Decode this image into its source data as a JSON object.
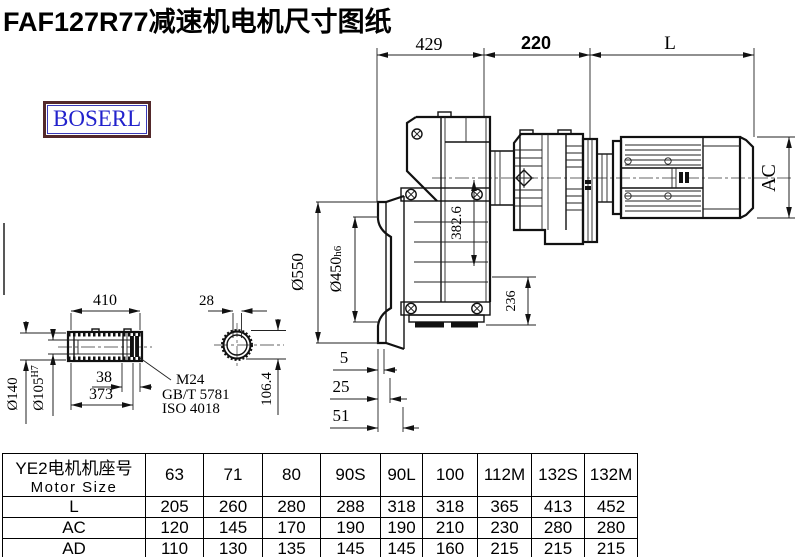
{
  "header": {
    "title": "FAF127R77减速机电机尺寸图纸",
    "logo_text": "BOSERL",
    "logo_text_color": "#2222cc",
    "logo_border_color": "#53292b"
  },
  "drawing": {
    "dims": {
      "top_left": "429",
      "top_mid": "220",
      "top_right": "L",
      "motor_height": "AC",
      "center_height": "382.6",
      "base_height": "236",
      "flange_od": "Ø550",
      "spigot": "Ø450",
      "spigot_tol": "h6",
      "gap1": "5",
      "gap2": "25",
      "gap3": "51",
      "shaft_len": "410",
      "shaft_od": "Ø140",
      "bore": "Ø105",
      "bore_tol": "H7",
      "key_len": "38",
      "thru_len": "373",
      "bolt": "M24",
      "std1": "GB/T 5781",
      "std2": "ISO 4018",
      "key_width": "28",
      "key_depth": "106.4"
    }
  },
  "table": {
    "header": {
      "line1": "YE2电机机座号",
      "line2": "Motor Size",
      "cols": [
        "63",
        "71",
        "80",
        "90S",
        "90L",
        "100",
        "112M",
        "132S",
        "132M"
      ]
    },
    "rows": [
      {
        "label": "L",
        "values": [
          "205",
          "260",
          "280",
          "288",
          "318",
          "318",
          "365",
          "413",
          "452"
        ]
      },
      {
        "label": "AC",
        "values": [
          "120",
          "145",
          "170",
          "190",
          "190",
          "210",
          "230",
          "280",
          "280"
        ]
      },
      {
        "label": "AD",
        "values": [
          "110",
          "130",
          "135",
          "145",
          "145",
          "160",
          "215",
          "215",
          "215"
        ]
      }
    ]
  }
}
